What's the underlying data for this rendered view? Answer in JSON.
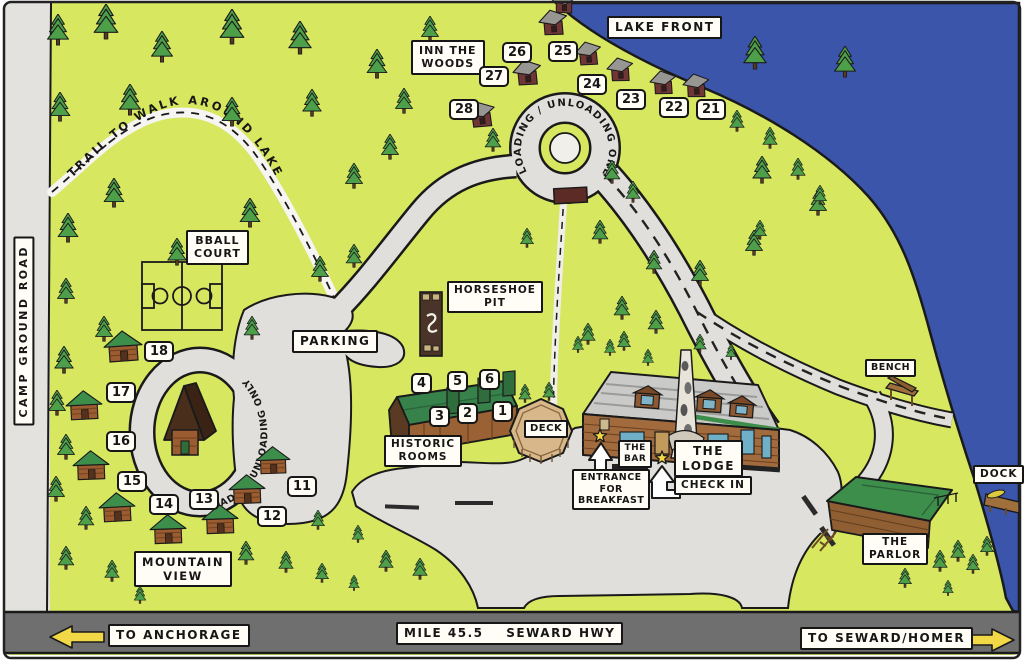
{
  "labels": {
    "lake_front": "LAKE FRONT",
    "inn_the_woods": "INN THE\nWOODS",
    "trail": "TRAIL  TO  WALK  AROUND  LAKE",
    "camp_ground_road": "CAMP GROUND ROAD",
    "bball_court": "BBALL\nCOURT",
    "parking": "PARKING",
    "horseshoe_pit": "HORSESHOE\nPIT",
    "loading_loop_top": "LOADING / UNLOADING ONLY",
    "loading_loop_left": "LOADING/UNLOADING ONLY",
    "historic_rooms": "HISTORIC\nROOMS",
    "deck": "DECK",
    "the_bar": "THE\nBAR",
    "the_lodge": "THE\nLODGE",
    "check_in": "CHECK IN",
    "entrance_breakfast": "ENTRANCE\nFOR\nBREAKFAST",
    "bench": "BENCH",
    "dock": "DOCK",
    "the_parlor": "THE\nPARLOR",
    "mountain_view": "MOUNTAIN\nVIEW",
    "to_anchorage": "TO ANCHORAGE",
    "mile_marker": "MILE 45.5    SEWARD HWY",
    "to_seward_homer": "TO SEWARD/HOMER"
  },
  "cabins": {
    "lakefront": [
      "28",
      "27",
      "26",
      "25",
      "24",
      "23",
      "22",
      "21"
    ],
    "mountain_view": [
      "18",
      "17",
      "16",
      "15",
      "14",
      "13",
      "12",
      "11"
    ]
  },
  "historic_rooms": {
    "top_row": [
      "4",
      "5",
      "6"
    ],
    "bottom_row": [
      "3",
      "2",
      "1"
    ]
  },
  "colors": {
    "grass": "#d7e75f",
    "lake": "#3a55a9",
    "road": "#e0dfdb",
    "highway": "#6f6f6f",
    "tree_green": "#4d9f4a",
    "roof_green": "#3e8e4b",
    "log_brown": "#a26b3e",
    "cabin_maroon": "#703636",
    "arrow_yellow": "#f2d846"
  }
}
